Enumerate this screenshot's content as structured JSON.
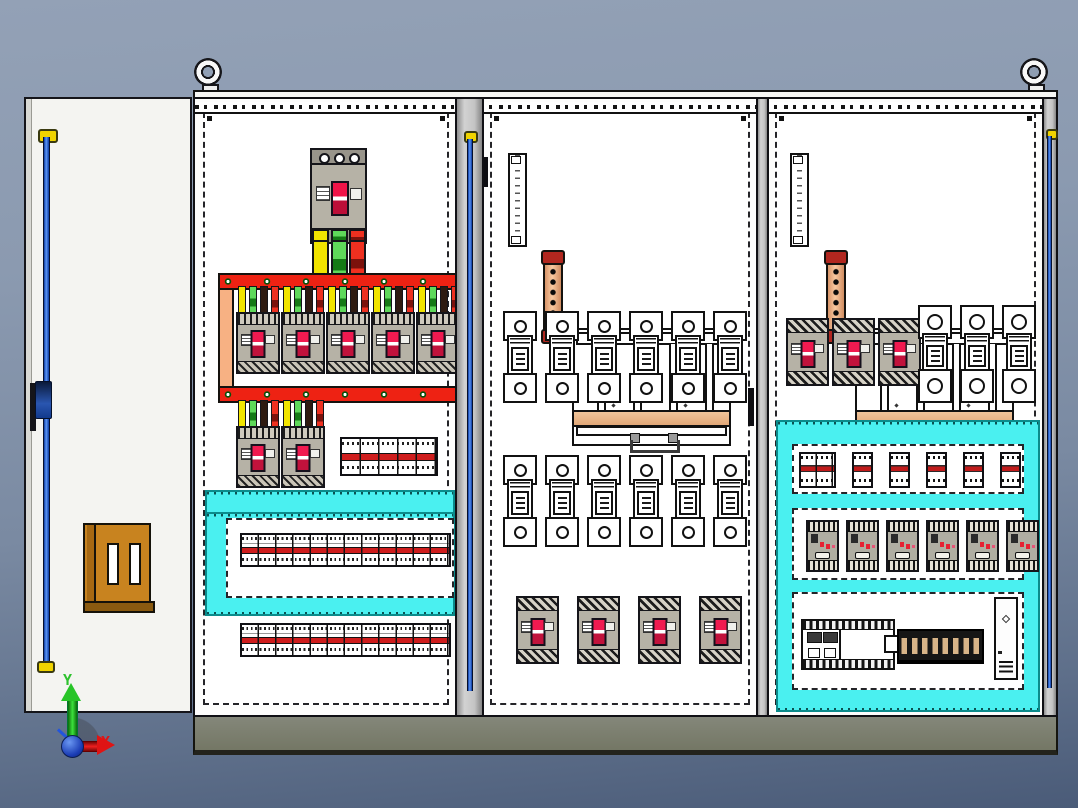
{
  "viewport": {
    "triad": {
      "x_label": "X",
      "y_label": "Y",
      "x_color": "#e01414",
      "y_color": "#2ec22e",
      "origin_color": "#1a3cb4"
    }
  },
  "assembly": {
    "name": "three-bay electrical distribution cabinet",
    "lifting_eyes": 2,
    "plinth_color": "#7b7e6d",
    "duct_color": "#4af0f0",
    "busbar_frame_color": "#ee2213",
    "left_door": {
      "lock_rod_color": "#2a62d8",
      "lock_block_color": "#c8831f"
    },
    "bays": [
      {
        "id": "incoming-bay",
        "main_breaker_count": 1,
        "feeder_breaker_count": 5,
        "sub_breaker_count": 2,
        "terminal_strip_rows": 3,
        "phase_strap_colors": [
          "#f2e400",
          "#5fd95a",
          "#2e1a10",
          "#ee3020"
        ]
      },
      {
        "id": "distribution-bay",
        "fuse_holder_rows": [
          6,
          6
        ],
        "outgoing_breaker_count": 4,
        "earth_busbar_color": "#e8a878"
      },
      {
        "id": "control-bay",
        "molded_breaker_count": 3,
        "fuse_holder_count": 3,
        "mini_breaker_modules": 6,
        "contactor_count": 6,
        "plc_count": 1,
        "terminal_block_count": 1,
        "power_supply_count": 1
      }
    ]
  }
}
